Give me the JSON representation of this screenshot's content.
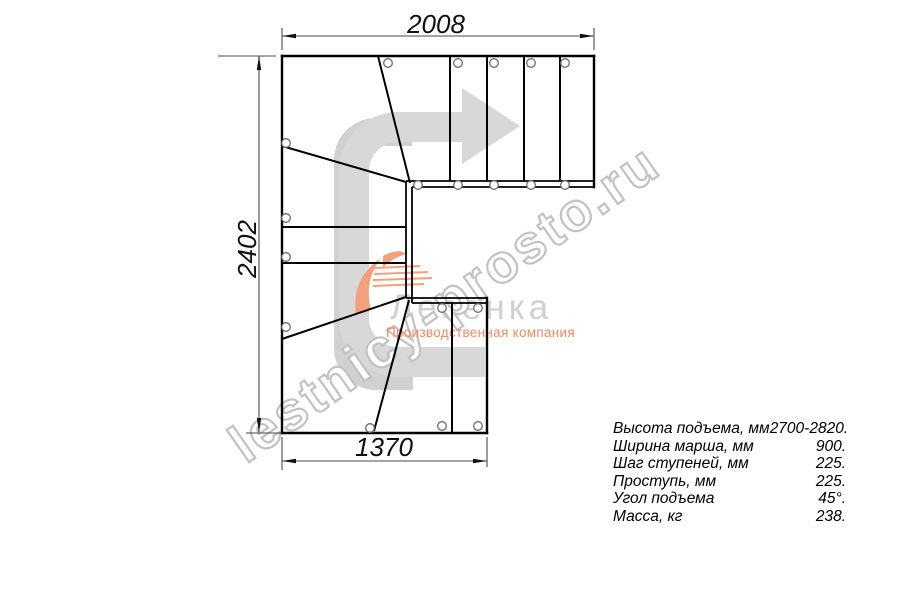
{
  "dimensions": {
    "top": "2008",
    "left": "2402",
    "bottom": "1370"
  },
  "watermark": {
    "site_text": "lestnicy-prosto.ru"
  },
  "logo": {
    "name": "Лесенка",
    "subtitle": "Производственная компания"
  },
  "specs": {
    "rows": [
      {
        "label": "Высота подъема, мм",
        "value": "2700-2820."
      },
      {
        "label": "Ширина марша, мм",
        "value": "900."
      },
      {
        "label": "Шаг ступеней, мм",
        "value": "225."
      },
      {
        "label": "Проступь, мм",
        "value": "225."
      },
      {
        "label": "Угол подъема",
        "value": "45°."
      },
      {
        "label": "Масса, кг",
        "value": "238."
      }
    ]
  },
  "colors": {
    "line": "#000000",
    "dimension_line": "#4a4a4a",
    "arrow_gray": "#d8d8d8",
    "logo_gray": "#c9c9c9",
    "logo_orange": "#f4a07c",
    "watermark_outline": "#c2c2c2"
  }
}
